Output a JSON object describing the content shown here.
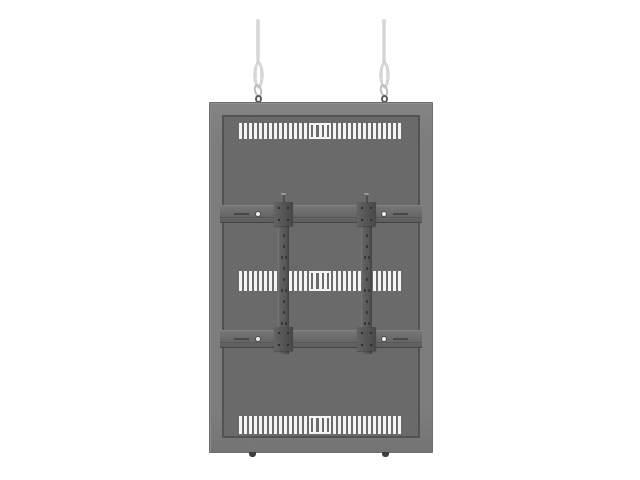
{
  "scene": {
    "background_color": "#ffffff",
    "alt_text": "Dark grey back panel of a display mount hanging from two thin steel wires with loops and hooks"
  },
  "colors": {
    "frame": "#7d7d7d",
    "frame_edge": "#525252",
    "panel": "#6a6a6a",
    "vent_slot": "#f4f4f4",
    "wire": "#d6d6d6",
    "hook": "#bdbdbd",
    "eye_bolt": "#5c5c5c",
    "rail_hole": "#383838",
    "screw_dot": "#eeeeee",
    "foot": "#3e3e3e"
  },
  "structure": {
    "wires": [
      {
        "side": "left"
      },
      {
        "side": "right"
      }
    ],
    "vent_rows": [
      {
        "id": "top",
        "slots_left": 14,
        "center_slots": 3,
        "slots_right": 14
      },
      {
        "id": "middle",
        "slots_left": 14,
        "center_slots": 3,
        "slots_right": 14
      },
      {
        "id": "bottom",
        "slots_left": 14,
        "center_slots": 3,
        "slots_right": 14
      }
    ],
    "vertical_rails": [
      {
        "side": "left",
        "hole_rows": 13
      },
      {
        "side": "right",
        "hole_rows": 13
      }
    ],
    "horizontal_rails": [
      {
        "position": "upper"
      },
      {
        "position": "lower"
      }
    ],
    "feet_count": 2
  }
}
